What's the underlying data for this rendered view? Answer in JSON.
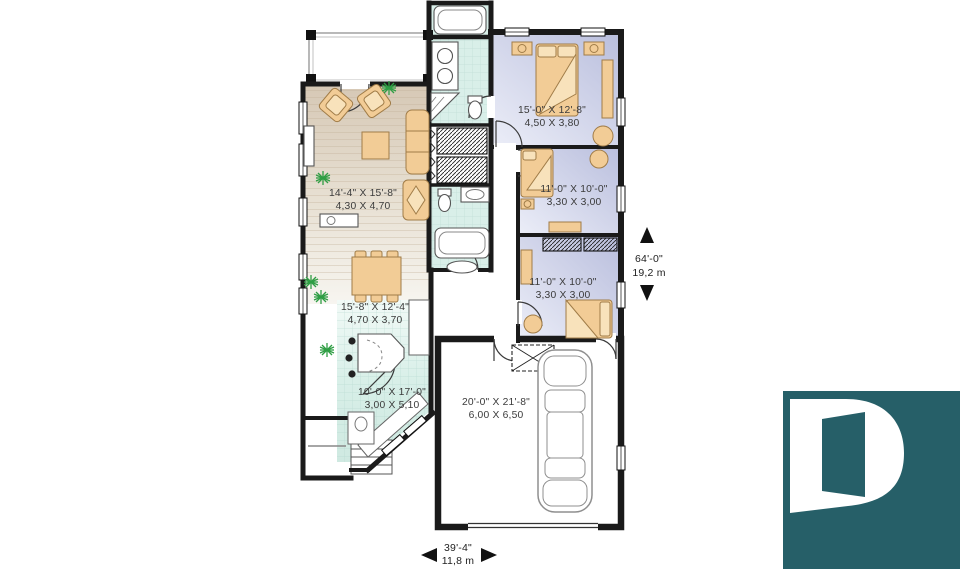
{
  "plan": {
    "rooms": [
      {
        "name": "living-room",
        "imperial": "14'-4\" X 15'-8\"",
        "metric": "4,30 X 4,70"
      },
      {
        "name": "master-bedroom",
        "imperial": "15'-0\" X 12'-8\"",
        "metric": "4,50 X 3,80"
      },
      {
        "name": "bedroom-2",
        "imperial": "11'-0\" X 10'-0\"",
        "metric": "3,30 X 3,00"
      },
      {
        "name": "bedroom-3",
        "imperial": "11'-0\" X 10'-0\"",
        "metric": "3,30 X 3,00"
      },
      {
        "name": "dining-room",
        "imperial": "15'-8\" X 12'-4\"",
        "metric": "4,70 X 3,70"
      },
      {
        "name": "kitchen",
        "imperial": "10'-0\" X 17'-0\"",
        "metric": "3,00 X 5,10"
      },
      {
        "name": "garage",
        "imperial": "20'-0\" X 21'-8\"",
        "metric": "6,00 X 6,50"
      }
    ],
    "overall": {
      "depth_imperial": "64'-0\"",
      "depth_metric": "19,2 m",
      "width_imperial": "39'-4\"",
      "width_metric": "11,8 m"
    },
    "colors": {
      "wall": "#1a1a1a",
      "wood_floor": "#d8cab6",
      "tile_floor": "#d2eae3",
      "bedroom_floor": "#c5c9e2",
      "furniture": "#f2cc96",
      "plant_green": "#2f9e44",
      "logo_teal": "#265f68"
    },
    "logo": {
      "glyph": "D"
    }
  }
}
